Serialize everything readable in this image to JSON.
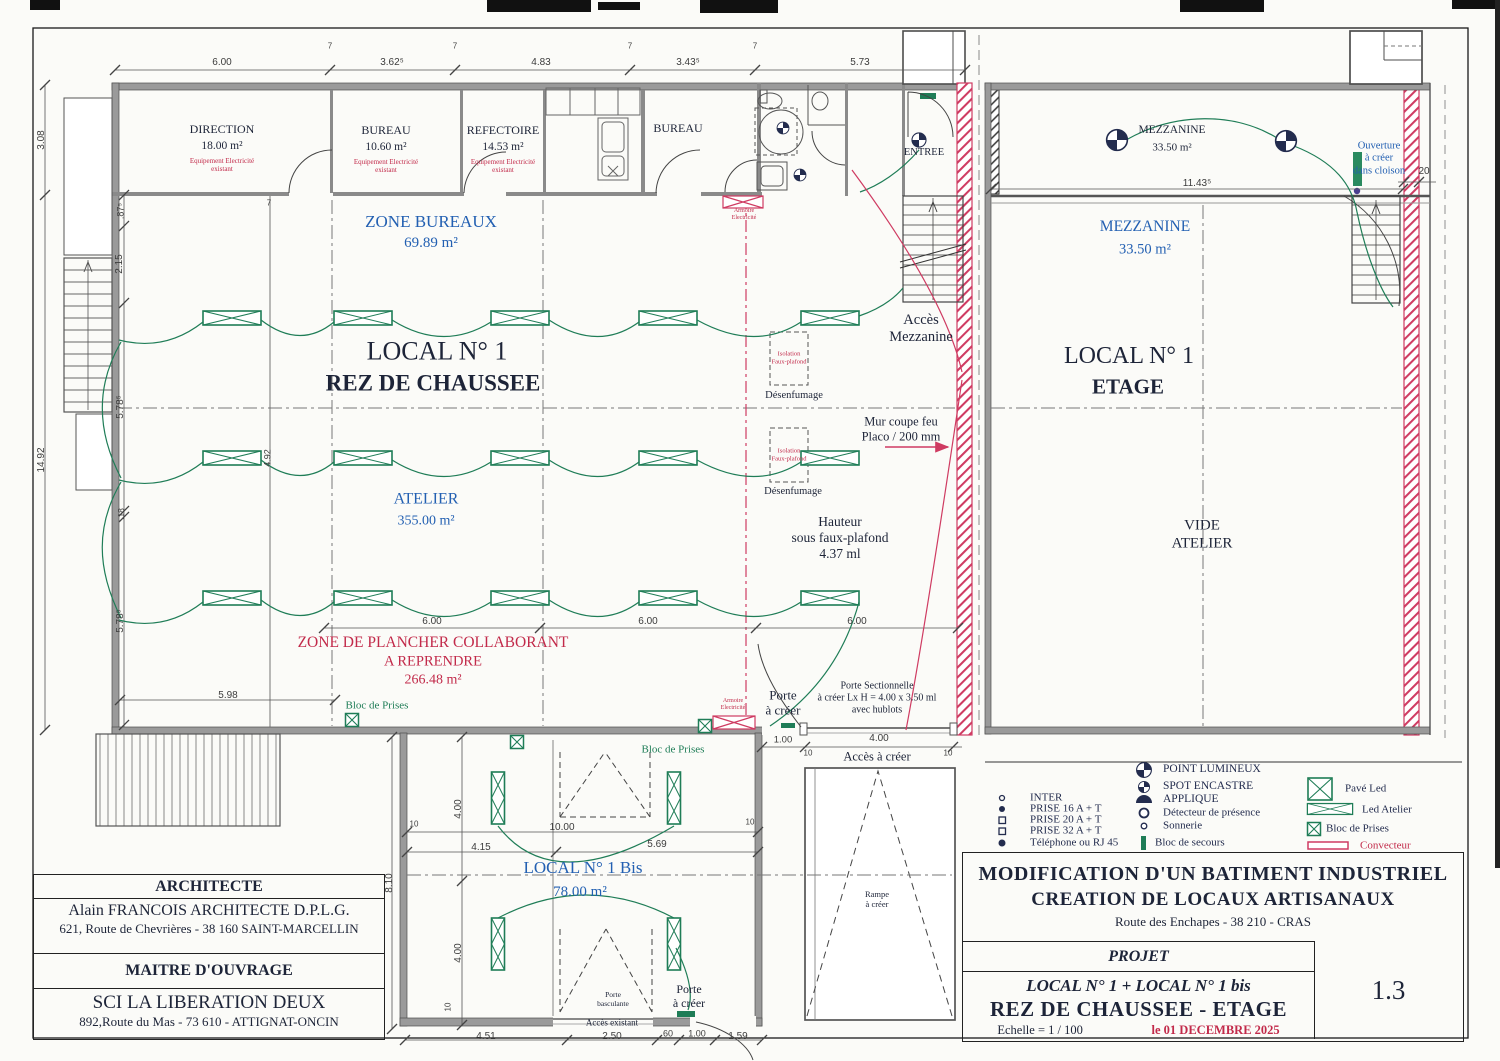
{
  "colors": {
    "accent_blue": "#2360b2",
    "accent_red": "#c22a4a",
    "accent_green": "#1f7d57",
    "wall_red": "#cf3b62",
    "navy": "#232c4e"
  },
  "title_block": {
    "line1": "MODIFICATION D'UN BATIMENT INDUSTRIEL",
    "line2": "CREATION DE LOCAUX ARTISANAUX",
    "line3": "Route des Enchapes   -   38 210 - CRAS",
    "projet": "PROJET",
    "local_line": "LOCAL N° 1 +  LOCAL N° 1 bis",
    "floor_line": "REZ DE CHAUSSEE - ETAGE",
    "scale": "Echelle = 1 / 100",
    "date": "le  01 DECEMBRE 2025",
    "sheet": "1.3"
  },
  "architect_block": {
    "header1": "ARCHITECTE",
    "name": "Alain FRANCOIS   ARCHITECTE D.P.L.G.",
    "address1": "621, Route de Chevrières - 38 160 SAINT-MARCELLIN",
    "header2": "MAITRE D'OUVRAGE",
    "owner": "SCI LA LIBERATION DEUX",
    "address2": "892,Route du Mas - 73 610 - ATTIGNAT-ONCIN"
  },
  "legend": {
    "items": [
      {
        "n": "legend-inter",
        "t": "INTER",
        "x": 1030,
        "y": 798,
        "s": 11,
        "c": "leg",
        "a": "l"
      },
      {
        "n": "legend-prise16",
        "t": "PRISE 16 A + T",
        "x": 1030,
        "y": 809,
        "s": 11,
        "c": "leg",
        "a": "l"
      },
      {
        "n": "legend-prise20",
        "t": "PRISE 20 A + T",
        "x": 1030,
        "y": 820,
        "s": 11,
        "c": "leg",
        "a": "l"
      },
      {
        "n": "legend-prise32",
        "t": "PRISE 32 A + T",
        "x": 1030,
        "y": 831,
        "s": 11,
        "c": "leg",
        "a": "l"
      },
      {
        "n": "legend-telephone",
        "t": "Téléphone ou RJ 45",
        "x": 1030,
        "y": 843,
        "s": 11,
        "c": "leg",
        "a": "l"
      },
      {
        "n": "legend-point-lumineux",
        "t": "POINT LUMINEUX",
        "x": 1163,
        "y": 770,
        "s": 11.5,
        "c": "leg",
        "a": "l"
      },
      {
        "n": "legend-spot-encastre",
        "t": "SPOT ENCASTRE",
        "x": 1163,
        "y": 787,
        "s": 11.5,
        "c": "leg",
        "a": "l"
      },
      {
        "n": "legend-applique",
        "t": "APPLIQUE",
        "x": 1163,
        "y": 800,
        "s": 11.5,
        "c": "leg",
        "a": "l"
      },
      {
        "n": "legend-detecteur",
        "t": "Détecteur de présence",
        "x": 1163,
        "y": 813,
        "s": 11,
        "c": "leg",
        "a": "l"
      },
      {
        "n": "legend-sonnerie",
        "t": "Sonnerie",
        "x": 1163,
        "y": 826,
        "s": 11,
        "c": "leg",
        "a": "l"
      },
      {
        "n": "legend-bloc-secours",
        "t": "Bloc de secours",
        "x": 1155,
        "y": 843,
        "s": 11,
        "c": "leg",
        "a": "l"
      },
      {
        "n": "legend-pave-led",
        "t": "Pavé Led",
        "x": 1345,
        "y": 789,
        "s": 11,
        "c": "leg",
        "a": "l"
      },
      {
        "n": "legend-led-atelier",
        "t": "Led Atelier",
        "x": 1362,
        "y": 810,
        "s": 11,
        "c": "leg",
        "a": "l"
      },
      {
        "n": "legend-bloc-prises",
        "t": "Bloc de Prises",
        "x": 1326,
        "y": 829,
        "s": 11,
        "c": "leg",
        "a": "l"
      },
      {
        "n": "legend-convecteur",
        "t": "Convecteur",
        "x": 1360,
        "y": 846,
        "s": 11,
        "c": "red",
        "a": "l"
      }
    ]
  },
  "plan_labels": [
    {
      "n": "room-direction",
      "t": "DIRECTION",
      "x": 222,
      "y": 129,
      "s": 12
    },
    {
      "n": "room-direction-area",
      "t": "18.00 m²",
      "x": 222,
      "y": 147,
      "s": 11.5
    },
    {
      "n": "room-direction-note",
      "t": "Equipement Electricité\nexistant",
      "x": 222,
      "y": 165,
      "s": 7,
      "c": "red"
    },
    {
      "n": "room-bureau1",
      "t": "BUREAU",
      "x": 386,
      "y": 130,
      "s": 12
    },
    {
      "n": "room-bureau1-area",
      "t": "10.60 m²",
      "x": 386,
      "y": 148,
      "s": 11.5
    },
    {
      "n": "room-bureau1-note",
      "t": "Equipement Electricité\nexistant",
      "x": 386,
      "y": 166,
      "s": 7,
      "c": "red"
    },
    {
      "n": "room-refectoire",
      "t": "REFECTOIRE",
      "x": 503,
      "y": 130,
      "s": 12
    },
    {
      "n": "room-refectoire-area",
      "t": "14.53 m²",
      "x": 503,
      "y": 148,
      "s": 11.5
    },
    {
      "n": "room-refectoire-note",
      "t": "Equipement Electricité\nexistant",
      "x": 503,
      "y": 166,
      "s": 7,
      "c": "red"
    },
    {
      "n": "room-bureau2",
      "t": "BUREAU",
      "x": 678,
      "y": 128,
      "s": 12
    },
    {
      "n": "entree",
      "t": "ENTREE",
      "x": 924,
      "y": 153,
      "s": 10.5
    },
    {
      "n": "zone-bureaux",
      "t": "ZONE BUREAUX",
      "x": 431,
      "y": 222,
      "s": 17,
      "c": "blue"
    },
    {
      "n": "zone-bureaux-area",
      "t": "69.89 m²",
      "x": 431,
      "y": 244,
      "s": 15,
      "c": "blue"
    },
    {
      "n": "local1-title",
      "t": "LOCAL N° 1",
      "x": 437,
      "y": 352,
      "s": 26
    },
    {
      "n": "local1-floor",
      "t": "REZ DE CHAUSSEE",
      "x": 433,
      "y": 383,
      "s": 23,
      "b": 1
    },
    {
      "n": "atelier",
      "t": "ATELIER",
      "x": 426,
      "y": 500,
      "s": 16,
      "c": "blue"
    },
    {
      "n": "atelier-area",
      "t": "355.00 m²",
      "x": 426,
      "y": 522,
      "s": 14,
      "c": "blue"
    },
    {
      "n": "zone-plancher-1",
      "t": "ZONE DE PLANCHER COLLABORANT",
      "x": 433,
      "y": 643,
      "s": 15.5,
      "c": "red"
    },
    {
      "n": "zone-plancher-2",
      "t": "A REPRENDRE",
      "x": 433,
      "y": 662,
      "s": 14.5,
      "c": "red"
    },
    {
      "n": "zone-plancher-area",
      "t": "266.48 m²",
      "x": 433,
      "y": 681,
      "s": 14,
      "c": "red"
    },
    {
      "n": "acces-mezzanine",
      "t": "Accès\nMezzanine",
      "x": 921,
      "y": 329,
      "s": 14.5
    },
    {
      "n": "isolation-1",
      "t": "Isolation\nFaux-plafond",
      "x": 789,
      "y": 358,
      "s": 6.5,
      "c": "red"
    },
    {
      "n": "desenfumage-1",
      "t": "Désenfumage",
      "x": 794,
      "y": 396,
      "s": 10.5
    },
    {
      "n": "isolation-2",
      "t": "Isolation\nFaux-plafond",
      "x": 789,
      "y": 455,
      "s": 6.5,
      "c": "red"
    },
    {
      "n": "desenfumage-2",
      "t": "Désenfumage",
      "x": 793,
      "y": 492,
      "s": 10.5
    },
    {
      "n": "mur-coupe-feu",
      "t": "Mur coupe feu\nPlaco / 200 mm",
      "x": 901,
      "y": 429,
      "s": 12.5
    },
    {
      "n": "hauteur-faux-plafond",
      "t": "Hauteur\nsous faux-plafond\n4.37 ml",
      "x": 840,
      "y": 538,
      "s": 13.5
    },
    {
      "n": "mezzanine-top",
      "t": "MEZZANINE",
      "x": 1172,
      "y": 131,
      "s": 11.5
    },
    {
      "n": "mezzanine-top-area",
      "t": "33.50 m²",
      "x": 1172,
      "y": 148,
      "s": 11
    },
    {
      "n": "ouverture-cloison",
      "t": "Ouverture\nà créer\ndans cloison",
      "x": 1379,
      "y": 159,
      "s": 10.5,
      "c": "blue"
    },
    {
      "n": "mezzanine-blue",
      "t": "MEZZANINE",
      "x": 1145,
      "y": 227,
      "s": 15.5,
      "c": "blue"
    },
    {
      "n": "mezzanine-blue-area",
      "t": "33.50 m²",
      "x": 1145,
      "y": 250,
      "s": 14.5,
      "c": "blue"
    },
    {
      "n": "local1-etage-title",
      "t": "LOCAL N° 1",
      "x": 1129,
      "y": 356,
      "s": 24
    },
    {
      "n": "local1-etage-floor",
      "t": "ETAGE",
      "x": 1128,
      "y": 387,
      "s": 21,
      "b": 1
    },
    {
      "n": "vide-atelier",
      "t": "VIDE\nATELIER",
      "x": 1202,
      "y": 535,
      "s": 15
    },
    {
      "n": "bloc-prises-1",
      "t": "Bloc de Prises",
      "x": 377,
      "y": 706,
      "s": 11,
      "c": "green"
    },
    {
      "n": "bloc-prises-2",
      "t": "Bloc de Prises",
      "x": 673,
      "y": 750,
      "s": 11,
      "c": "green"
    },
    {
      "n": "armoire-electricite-1",
      "t": "Armoire\nElectricité",
      "x": 744,
      "y": 215,
      "s": 6,
      "c": "red"
    },
    {
      "n": "armoire-electricite-2",
      "t": "Armoire\nElectricité",
      "x": 733,
      "y": 705,
      "s": 6,
      "c": "red"
    },
    {
      "n": "porte-a-creer-1",
      "t": "Porte\nà créer",
      "x": 783,
      "y": 703,
      "s": 13
    },
    {
      "n": "porte-sectionnelle",
      "t": "Porte Sectionnelle\nà créer  Lx H = 4.00 x 3.50 ml\navec hublots",
      "x": 877,
      "y": 698,
      "s": 10
    },
    {
      "n": "acces-a-creer",
      "t": "Accès à créer",
      "x": 877,
      "y": 757,
      "s": 12.5
    },
    {
      "n": "local1bis-title",
      "t": "LOCAL N° 1 Bis",
      "x": 583,
      "y": 868,
      "s": 17,
      "c": "blue"
    },
    {
      "n": "local1bis-area",
      "t": "78.00 m²",
      "x": 580,
      "y": 893,
      "s": 15,
      "c": "blue"
    },
    {
      "n": "porte-basculante",
      "t": "Porte\nbasculante",
      "x": 613,
      "y": 1000,
      "s": 7.5
    },
    {
      "n": "acces-existant",
      "t": "Accès existant",
      "x": 612,
      "y": 1023,
      "s": 9
    },
    {
      "n": "porte-a-creer-2",
      "t": "Porte\nà créer",
      "x": 689,
      "y": 996,
      "s": 12
    },
    {
      "n": "rampe-a-creer",
      "t": "Rampe\nà créer",
      "x": 877,
      "y": 899,
      "s": 8.5
    },
    {
      "n": "dim",
      "t": "6.00",
      "x": 222,
      "y": 63,
      "s": 10,
      "c": "dim"
    },
    {
      "n": "dim",
      "t": "3.62⁵",
      "x": 392,
      "y": 63,
      "s": 10,
      "c": "dim"
    },
    {
      "n": "dim",
      "t": "4.83",
      "x": 541,
      "y": 63,
      "s": 10,
      "c": "dim"
    },
    {
      "n": "dim",
      "t": "3.43⁵",
      "x": 688,
      "y": 63,
      "s": 10,
      "c": "dim"
    },
    {
      "n": "dim",
      "t": "5.73",
      "x": 860,
      "y": 63,
      "s": 10,
      "c": "dim"
    },
    {
      "n": "dim",
      "t": "7",
      "x": 330,
      "y": 46,
      "s": 8,
      "c": "dim"
    },
    {
      "n": "dim",
      "t": "7",
      "x": 455,
      "y": 46,
      "s": 8,
      "c": "dim"
    },
    {
      "n": "dim",
      "t": "7",
      "x": 630,
      "y": 46,
      "s": 8,
      "c": "dim"
    },
    {
      "n": "dim",
      "t": "7",
      "x": 755,
      "y": 46,
      "s": 8,
      "c": "dim"
    },
    {
      "n": "dim",
      "t": "3.08",
      "x": 42,
      "y": 140,
      "s": 10,
      "c": "dim",
      "r": 1
    },
    {
      "n": "dim",
      "t": "14.92",
      "x": 42,
      "y": 460,
      "s": 10,
      "c": "dim",
      "r": 1
    },
    {
      "n": "dim",
      "t": ".87⁵",
      "x": 121,
      "y": 211,
      "s": 9,
      "c": "dim",
      "r": 1
    },
    {
      "n": "dim",
      "t": "2.15",
      "x": 120,
      "y": 264,
      "s": 10,
      "c": "dim",
      "r": 1
    },
    {
      "n": "dim",
      "t": "5.78⁵",
      "x": 121,
      "y": 407,
      "s": 10,
      "c": "dim",
      "r": 1
    },
    {
      "n": "dim",
      "t": ".18",
      "x": 121,
      "y": 514,
      "s": 8.5,
      "c": "dim",
      "r": 1
    },
    {
      "n": "dim",
      "t": "5.78⁵",
      "x": 121,
      "y": 621,
      "s": 10,
      "c": "dim",
      "r": 1
    },
    {
      "n": "dim",
      "t": "7",
      "x": 269,
      "y": 203,
      "s": 8,
      "c": "dim"
    },
    {
      "n": "dim",
      "t": "4.92",
      "x": 268,
      "y": 458,
      "s": 9,
      "c": "dim",
      "r": 1
    },
    {
      "n": "dim",
      "t": "6.00",
      "x": 432,
      "y": 622,
      "s": 10,
      "c": "dim"
    },
    {
      "n": "dim",
      "t": "6.00",
      "x": 648,
      "y": 622,
      "s": 10,
      "c": "dim"
    },
    {
      "n": "dim",
      "t": "6.00",
      "x": 857,
      "y": 622,
      "s": 10,
      "c": "dim"
    },
    {
      "n": "dim",
      "t": "5.98",
      "x": 228,
      "y": 696,
      "s": 10,
      "c": "dim"
    },
    {
      "n": "dim",
      "t": "11.43⁵",
      "x": 1197,
      "y": 184,
      "s": 10,
      "c": "dim"
    },
    {
      "n": "dim",
      "t": "20",
      "x": 1424,
      "y": 172,
      "s": 10,
      "c": "dim"
    },
    {
      "n": "dim",
      "t": "1.00",
      "x": 783,
      "y": 740,
      "s": 9.5,
      "c": "dim"
    },
    {
      "n": "dim",
      "t": "4.00",
      "x": 879,
      "y": 739,
      "s": 10,
      "c": "dim"
    },
    {
      "n": "dim",
      "t": "10",
      "x": 808,
      "y": 753,
      "s": 8,
      "c": "dim"
    },
    {
      "n": "dim",
      "t": "10",
      "x": 948,
      "y": 753,
      "s": 8,
      "c": "dim"
    },
    {
      "n": "dim",
      "t": "8.10",
      "x": 390,
      "y": 883,
      "s": 10,
      "c": "dim",
      "r": 1
    },
    {
      "n": "dim",
      "t": "4.00",
      "x": 459,
      "y": 809,
      "s": 10,
      "c": "dim",
      "r": 1
    },
    {
      "n": "dim",
      "t": "4.00",
      "x": 459,
      "y": 953,
      "s": 10,
      "c": "dim",
      "r": 1
    },
    {
      "n": "dim",
      "t": "10",
      "x": 414,
      "y": 824,
      "s": 8,
      "c": "dim"
    },
    {
      "n": "dim",
      "t": "10",
      "x": 750,
      "y": 822,
      "s": 8,
      "c": "dim"
    },
    {
      "n": "dim",
      "t": "10.00",
      "x": 562,
      "y": 828,
      "s": 10,
      "c": "dim"
    },
    {
      "n": "dim",
      "t": "4.15",
      "x": 481,
      "y": 848,
      "s": 10,
      "c": "dim"
    },
    {
      "n": "dim",
      "t": "5.69",
      "x": 657,
      "y": 845,
      "s": 10,
      "c": "dim"
    },
    {
      "n": "dim",
      "t": "10",
      "x": 448,
      "y": 1007,
      "s": 8,
      "c": "dim",
      "r": 1
    },
    {
      "n": "dim",
      "t": "4.51",
      "x": 486,
      "y": 1037,
      "s": 10,
      "c": "dim"
    },
    {
      "n": "dim",
      "t": "2.50",
      "x": 612,
      "y": 1037,
      "s": 10,
      "c": "dim"
    },
    {
      "n": "dim",
      "t": "60",
      "x": 668,
      "y": 1034,
      "s": 9,
      "c": "dim"
    },
    {
      "n": "dim",
      "t": "1.00",
      "x": 697,
      "y": 1034,
      "s": 9,
      "c": "dim"
    },
    {
      "n": "dim",
      "t": "1.59",
      "x": 738,
      "y": 1037,
      "s": 10,
      "c": "dim"
    }
  ]
}
